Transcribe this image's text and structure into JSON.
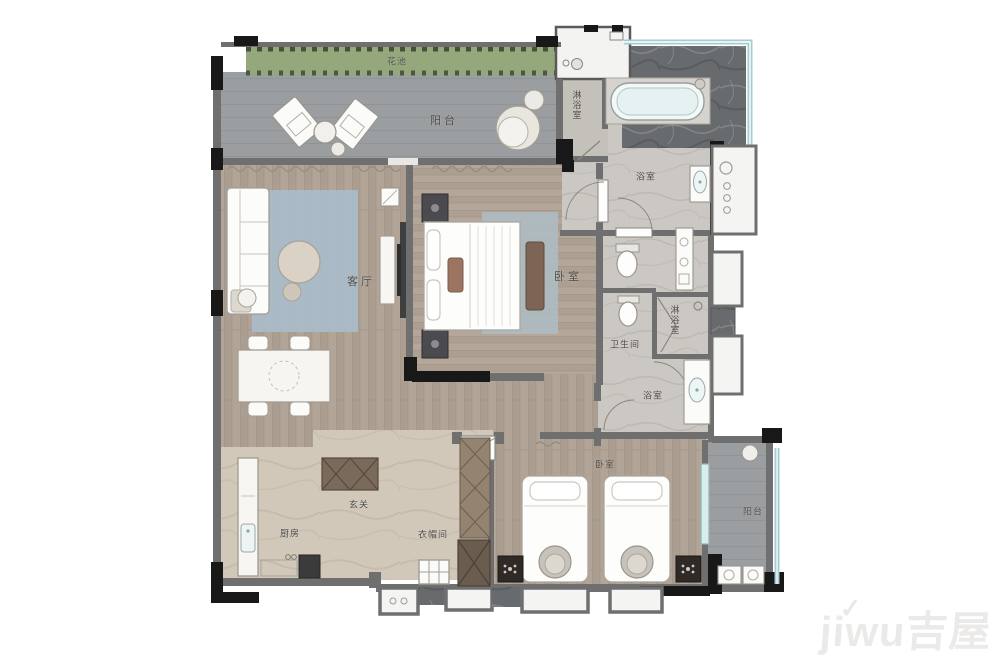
{
  "rooms": {
    "flower_bed": "花池",
    "balcony_top": "阳台",
    "shower_top": "淋浴室",
    "bath_top": "浴室",
    "living_room": "客厅",
    "master_bedroom": "卧室",
    "toilet": "卫生间",
    "shower_mid": "淋浴室",
    "bath_mid": "浴室",
    "foyer": "玄关",
    "kitchen": "厨房",
    "cloakroom": "衣帽间",
    "bedroom_second": "卧室",
    "balcony_right": "阳台"
  },
  "watermark": {
    "brand": "jiwu",
    "cn": "吉屋"
  },
  "colors": {
    "wall_grey": "#6f6f6f",
    "wall_black": "#1a1a1a",
    "wood_floor": "#b1a497",
    "marble_light": "#cbc7c2",
    "marble_beige": "#d1c8ba",
    "marble_dark": "#686b6e",
    "balcony_grey": "#9b9ea0",
    "flower_green": "#94a87c",
    "rug_blue": "#a9bdcb",
    "window_teal": "#a5cdd1",
    "label_text": "#4c4a46"
  }
}
